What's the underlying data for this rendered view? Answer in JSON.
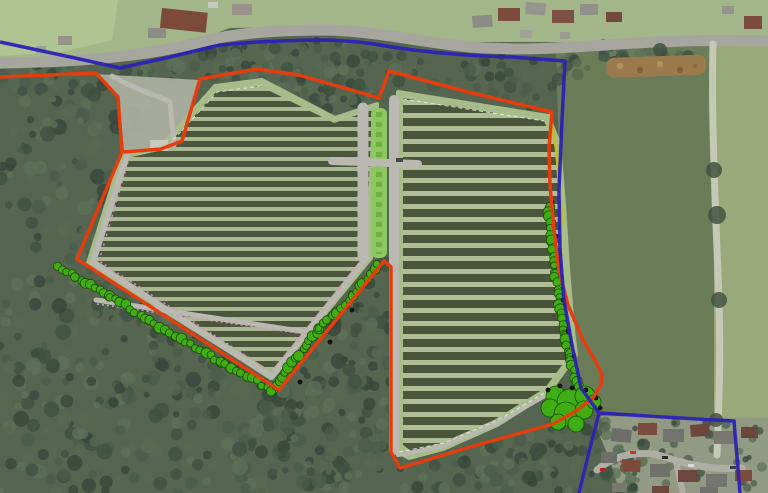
{
  "title": "Aerial solar farm site layout plan with red site boundary and blue application boundary",
  "canvas": {
    "width": 768,
    "height": 493
  },
  "palette": {
    "base_wood": "#55654f",
    "red_boundary": "#e63d0e",
    "blue_boundary": "#2c22b5",
    "hedge_green": "#3fae12",
    "hedge_outline": "#1c4a04",
    "yellow_line": "#c9bc10",
    "pink_fence": "#d49ab4",
    "white_fence": "#eeeee6",
    "road_gray": "#a6a69e",
    "track_gray": "#b9b9b1"
  },
  "background": {
    "north_band": {
      "points": "0,0 768,0 768,38 600,42 430,42 300,27 230,28 150,58 80,62 0,58",
      "fill": "#a3b689"
    },
    "nw_field": {
      "points": "0,0 118,0 112,40 60,52 0,56",
      "fill": "#b0c492"
    },
    "east_field": {
      "points": "556,52 714,43 714,452 680,440 640,428 598,414 580,390 568,330 560,230 558,120",
      "fill": "#6b7c59"
    },
    "east_field_light": {
      "points": "714,43 768,40 768,458 714,452",
      "fill": "#9aa979"
    },
    "estate": {
      "points": "598,416 768,418 768,493 620,493 610,460 598,432",
      "fill": "#939a84"
    }
  },
  "woodland": {
    "colors": [
      "#3e5142",
      "#4a5e4b",
      "#57694f",
      "#35463a",
      "#5e7158"
    ],
    "parcels": [
      {
        "name": "west-woodland",
        "points": [
          [
            0,
            68
          ],
          [
            120,
            78
          ],
          [
            168,
            96
          ],
          [
            122,
            152
          ],
          [
            88,
            262
          ],
          [
            275,
            386
          ],
          [
            232,
            493
          ],
          [
            0,
            493
          ]
        ],
        "count": 340,
        "rmin": 3,
        "rmax": 8
      },
      {
        "name": "roadside-belt-west",
        "points": [
          [
            0,
            66
          ],
          [
            150,
            62
          ],
          [
            225,
            45
          ],
          [
            285,
            33
          ],
          [
            330,
            37
          ],
          [
            380,
            52
          ],
          [
            378,
            100
          ],
          [
            330,
            114
          ],
          [
            262,
            78
          ],
          [
            215,
            84
          ],
          [
            150,
            90
          ],
          [
            80,
            86
          ]
        ],
        "count": 120,
        "rmin": 3,
        "rmax": 7
      },
      {
        "name": "roadside-belt-east",
        "points": [
          [
            380,
            52
          ],
          [
            440,
            54
          ],
          [
            520,
            56
          ],
          [
            600,
            47
          ],
          [
            640,
            44
          ],
          [
            600,
            62
          ],
          [
            548,
            112
          ],
          [
            470,
            90
          ],
          [
            400,
            86
          ],
          [
            385,
            95
          ]
        ],
        "count": 60,
        "rmin": 3,
        "rmax": 7
      },
      {
        "name": "central-wedge",
        "points": [
          [
            272,
            392
          ],
          [
            380,
            262
          ],
          [
            391,
            262
          ],
          [
            391,
            470
          ],
          [
            345,
            493
          ],
          [
            240,
            493
          ],
          [
            235,
            470
          ]
        ],
        "count": 170,
        "rmin": 3,
        "rmax": 8
      },
      {
        "name": "south-belt",
        "points": [
          [
            391,
            470
          ],
          [
            455,
            455
          ],
          [
            540,
            430
          ],
          [
            600,
            418
          ],
          [
            648,
            443
          ],
          [
            636,
            493
          ],
          [
            391,
            493
          ]
        ],
        "count": 110,
        "rmin": 3,
        "rmax": 7
      },
      {
        "name": "junction-trees",
        "points": [
          [
            600,
            44
          ],
          [
            660,
            42
          ],
          [
            700,
            60
          ],
          [
            640,
            70
          ],
          [
            600,
            60
          ]
        ],
        "count": 25,
        "rmin": 3,
        "rmax": 6
      },
      {
        "name": "estate-gardens",
        "points": [
          [
            594,
            420
          ],
          [
            768,
            424
          ],
          [
            768,
            490
          ],
          [
            600,
            490
          ]
        ],
        "count": 45,
        "rmin": 2,
        "rmax": 5
      }
    ]
  },
  "roads": [
    {
      "name": "main-road",
      "d": "M0,63 C70,62 140,58 200,42 C240,32 280,30 330,30 C380,32 420,42 470,47 C520,51 560,48 620,44 C680,40 720,40 768,41",
      "color": "#a6a69e",
      "width": 11
    },
    {
      "name": "field-track-east",
      "d": "M713,44 C711,120 716,220 719,300 C721,370 718,420 717,455",
      "color": "#c6c8b6",
      "width": 7
    },
    {
      "name": "estate-road",
      "d": "M597,470 C618,452 646,450 668,458 C692,466 714,470 742,468",
      "color": "#aeaea4",
      "width": 7
    },
    {
      "name": "estate-road-spur",
      "d": "M676,462 L683,493",
      "color": "#aeaea4",
      "width": 6
    }
  ],
  "track_trees": [
    [
      714,
      170,
      8
    ],
    [
      717,
      215,
      9
    ],
    [
      719,
      300,
      8
    ],
    [
      716,
      420,
      7
    ],
    [
      660,
      50,
      7
    ],
    [
      688,
      56,
      6
    ]
  ],
  "neck": {
    "points": "96,74 200,80 182,141 161,149 124,151 119,97",
    "fill": "#aeb1a2"
  },
  "solar_arrays": [
    {
      "name": "west-array",
      "outline": "160,148 215,86 262,80 335,118 377,104 371,258 272,378 88,263 122,155",
      "inner": "163,150 216,92 260,86 334,123 372,110 366,256 271,371 95,262 127,158",
      "margin": "#a8bc8a",
      "row": "#4b563d",
      "gap": "#a9b792",
      "pitch": 10,
      "row_h": 6
    },
    {
      "name": "east-array",
      "outline": "398,92 548,116 559,143 564,205 568,268 573,330 576,355 548,393 497,425 443,449 409,458 396,451",
      "inner": "403,98 544,121 555,147 559,206 563,268 568,330 571,353 545,388 494,420 441,443 411,451 403,445",
      "margin": "#a8bc8a",
      "row": "#4a553c",
      "gap": "#b0bd97",
      "pitch": 13,
      "row_h": 8
    }
  ],
  "central_strip": {
    "x": 371,
    "y": 108,
    "w": 16,
    "h": 150,
    "fill": "#8dc75f",
    "dash": "#6fb042"
  },
  "tracks": [
    {
      "name": "access-track",
      "d": "M112,76 C140,92 160,96 170,102 L174,145",
      "width": 5
    },
    {
      "name": "west-perimeter-track",
      "d": "M127,156 L93,262 L271,377",
      "width": 6
    },
    {
      "name": "west-se-track",
      "d": "M271,377 L366,258",
      "width": 6
    },
    {
      "name": "west-mid-track",
      "d": "M96,300 L320,334",
      "width": 5
    },
    {
      "name": "center-track-west",
      "d": "M363,108 L363,257",
      "width": 11
    },
    {
      "name": "center-track-east",
      "d": "M394,100 L394,450",
      "width": 10
    },
    {
      "name": "crossing-track",
      "d": "M332,161 L418,164",
      "width": 8
    },
    {
      "name": "east-bottom-track",
      "d": "M398,455 L444,446 L498,423 L550,393",
      "width": 4
    }
  ],
  "compound": {
    "x": 150,
    "y": 140,
    "w": 18,
    "h": 11,
    "fill": "#c9c9c0"
  },
  "vehicle": {
    "x": 396,
    "y": 158,
    "w": 7,
    "h": 4,
    "fill": "#44464a"
  },
  "fences_pink": [
    {
      "d": "M128,162 L99,261 L268,370"
    },
    {
      "d": "M364,258 L272,372"
    },
    {
      "d": "M97,304 L318,336"
    }
  ],
  "fences_white": [
    {
      "d": "M164,150 L217,92 L261,86"
    },
    {
      "d": "M403,99 L544,121"
    },
    {
      "d": "M399,452 L444,443 L498,420 L548,391"
    }
  ],
  "hedgerows": {
    "chains": [
      {
        "name": "southwest-hedgerow",
        "pts": [
          [
            57,
            266
          ],
          [
            110,
            296
          ],
          [
            165,
            330
          ],
          [
            220,
            362
          ],
          [
            272,
            390
          ]
        ]
      },
      {
        "name": "southeast-hedgerow",
        "pts": [
          [
            272,
            390
          ],
          [
            320,
            328
          ],
          [
            352,
            296
          ],
          [
            378,
            264
          ]
        ]
      },
      {
        "name": "east-hedgerow",
        "pts": [
          [
            549,
            206
          ],
          [
            552,
            240
          ],
          [
            555,
            272
          ],
          [
            559,
            304
          ],
          [
            564,
            335
          ],
          [
            570,
            360
          ],
          [
            578,
            388
          ]
        ]
      }
    ],
    "cluster": [
      [
        556,
        396,
        10
      ],
      [
        570,
        402,
        13
      ],
      [
        585,
        396,
        10
      ],
      [
        550,
        408,
        9
      ],
      [
        566,
        414,
        12
      ],
      [
        584,
        410,
        9
      ],
      [
        594,
        402,
        7
      ],
      [
        558,
        422,
        8
      ],
      [
        576,
        424,
        8
      ]
    ],
    "dots": [
      [
        552,
        202
      ],
      [
        556,
        236
      ],
      [
        559,
        268
      ],
      [
        563,
        300
      ],
      [
        568,
        331
      ],
      [
        574,
        356
      ],
      [
        548,
        390
      ],
      [
        560,
        386
      ],
      [
        572,
        388
      ],
      [
        586,
        390
      ],
      [
        596,
        398
      ],
      [
        600,
        408
      ],
      [
        300,
        382
      ],
      [
        330,
        342
      ],
      [
        352,
        310
      ]
    ]
  },
  "heap": {
    "x": 606,
    "y": 58,
    "w": 100,
    "h": 20,
    "fill": "#9b7b4e",
    "speckles": [
      [
        620,
        66,
        3,
        "#b59263"
      ],
      [
        640,
        70,
        3,
        "#7a5c39"
      ],
      [
        660,
        64,
        3,
        "#b59263"
      ],
      [
        680,
        70,
        3,
        "#7a5c39"
      ],
      [
        695,
        66,
        2,
        "#8a6b42"
      ]
    ]
  },
  "houses": {
    "north_west": [
      [
        162,
        8,
        46,
        20,
        6,
        "#7b4a39"
      ],
      [
        148,
        28,
        18,
        10,
        0,
        "#8d8d85"
      ],
      [
        58,
        36,
        14,
        9,
        0,
        "#94948a"
      ],
      [
        36,
        46,
        10,
        7,
        0,
        "#9e9e94"
      ],
      [
        208,
        2,
        10,
        6,
        0,
        "#c9c9c1"
      ],
      [
        232,
        4,
        20,
        11,
        0,
        "#98928a"
      ]
    ],
    "north_east": [
      [
        472,
        16,
        20,
        12,
        -4,
        "#8c8c84"
      ],
      [
        498,
        8,
        22,
        13,
        0,
        "#7c4b3d"
      ],
      [
        526,
        2,
        20,
        12,
        4,
        "#95958d"
      ],
      [
        552,
        10,
        22,
        13,
        0,
        "#7e5146"
      ],
      [
        580,
        4,
        18,
        11,
        0,
        "#90908a"
      ],
      [
        606,
        12,
        16,
        10,
        0,
        "#744a3e"
      ],
      [
        520,
        30,
        12,
        8,
        0,
        "#a0a098"
      ],
      [
        560,
        32,
        10,
        7,
        0,
        "#9a9a92"
      ],
      [
        744,
        16,
        18,
        13,
        0,
        "#7c4b3d"
      ],
      [
        722,
        6,
        12,
        8,
        0,
        "#93938b"
      ]
    ],
    "estate": [
      [
        612,
        428,
        20,
        13,
        6,
        "#6e6e68"
      ],
      [
        638,
        423,
        19,
        12,
        0,
        "#7d4b3d"
      ],
      [
        663,
        429,
        21,
        13,
        0,
        "#73736d"
      ],
      [
        690,
        425,
        19,
        12,
        -4,
        "#6d473c"
      ],
      [
        714,
        431,
        21,
        13,
        0,
        "#78786f"
      ],
      [
        741,
        427,
        17,
        11,
        0,
        "#6d473c"
      ],
      [
        601,
        452,
        16,
        11,
        0,
        "#6f6f69"
      ],
      [
        622,
        459,
        19,
        12,
        4,
        "#7d4b3d"
      ],
      [
        650,
        464,
        20,
        13,
        0,
        "#71716b"
      ],
      [
        678,
        470,
        19,
        12,
        0,
        "#6d473c"
      ],
      [
        706,
        474,
        21,
        13,
        0,
        "#75756f"
      ],
      [
        735,
        470,
        17,
        11,
        0,
        "#7d4b3d"
      ],
      [
        612,
        483,
        15,
        9,
        0,
        "#78786f"
      ],
      [
        652,
        486,
        17,
        10,
        0,
        "#6d473c"
      ],
      [
        700,
        487,
        18,
        10,
        0,
        "#71716b"
      ]
    ]
  },
  "cars": [
    [
      630,
      451,
      6,
      3,
      "#c23a2a"
    ],
    [
      662,
      456,
      6,
      3,
      "#2e2e2e"
    ],
    [
      688,
      464,
      6,
      3,
      "#d8d8d0"
    ],
    [
      600,
      468,
      5,
      3,
      "#b02020"
    ],
    [
      730,
      466,
      6,
      3,
      "#3a3a46"
    ]
  ],
  "boundaries": {
    "red": {
      "name": "site-boundary-red",
      "color": "#e63d0e",
      "width": 3.5,
      "d": "M0,77 L96,73 L118,97 L122,152 L77,259 L279,390 L384,261 L391,267 L391,452 L400,468 L470,447 L553,424 L576,411 L593,398 L601,385 L602,375 L596,362 L583,340 L568,305 L559,270 L554,230 L550,185 L549,148 L552,112 L468,92 L389,71 L379,98 L299,75 L257,69 L200,79 L182,141 L161,149 L124,152"
    },
    "blue": {
      "name": "application-boundary-blue",
      "color": "#2c22b5",
      "width": 3.5,
      "d": "M0,42 L75,58 L120,68 L170,57 L220,45 L256,42 C300,40 340,38 380,45 C420,52 470,56 511,57 L565,61 L562,120 L559,190 L560,250 L564,300 L572,345 L581,388 L599,413 L680,418 L734,421 L740,493"
    },
    "blue_spur": {
      "name": "application-boundary-blue-spur",
      "color": "#2c22b5",
      "width": 3.5,
      "d": "M599,413 L589,452 L579,493"
    },
    "yellow": {
      "name": "landscape-edge-yellow",
      "color": "#c9bc10",
      "width": 2.5,
      "d": "M550,110 L556,150 L560,190 L563,225"
    }
  }
}
